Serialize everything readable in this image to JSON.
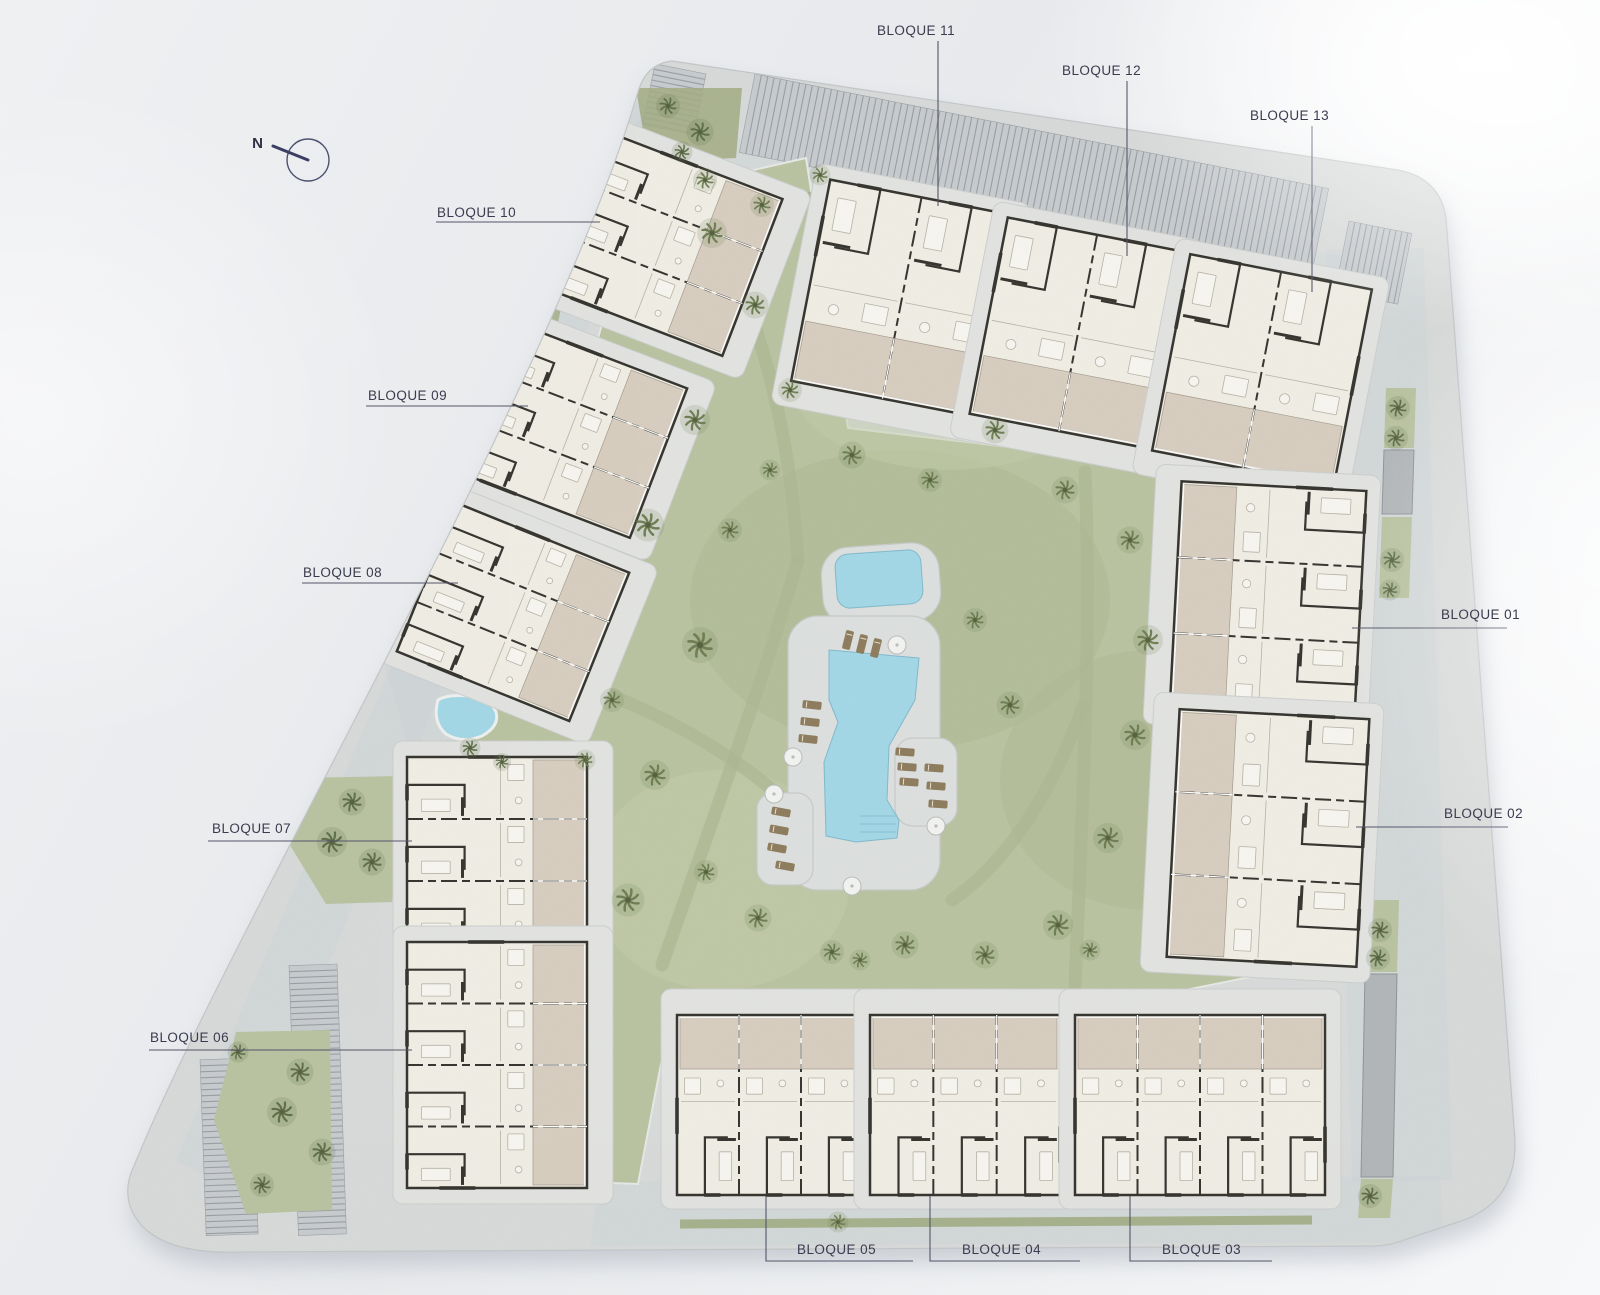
{
  "north": {
    "label": "N"
  },
  "labels": {
    "b01": "BLOQUE 01",
    "b02": "BLOQUE 02",
    "b03": "BLOQUE 03",
    "b04": "BLOQUE 04",
    "b05": "BLOQUE 05",
    "b06": "BLOQUE 06",
    "b07": "BLOQUE 07",
    "b08": "BLOQUE 08",
    "b09": "BLOQUE 09",
    "b10": "BLOQUE 10",
    "b11": "BLOQUE 11",
    "b12": "BLOQUE 12",
    "b13": "BLOQUE 13"
  },
  "palette": {
    "pavement": "#d8dad9",
    "pavementEdge": "#c2c5c6",
    "shadow": "#a9aeb8",
    "road": "#ccd3d6",
    "lawn": "#b9c2a0",
    "lawnDark": "#adb791",
    "lawnLight": "#c4cca9",
    "hedge": "#a2ac83",
    "palm": "#6e7d52",
    "palmDark": "#5f6f49",
    "water": "#a3d7e6",
    "waterEdge": "#7fb9cc",
    "deck": "#dcdfdd",
    "deckEdge": "#c7cac8",
    "lounger": "#8d7b5c",
    "umbrella": "#f2f3f1",
    "room": "#f0ede4",
    "terrace": "#d7cdbf",
    "wall": "#34332d",
    "roomLine": "#b6b2a5",
    "apron": "#e2e3e0",
    "apronEdge": "#cbcecd",
    "parking": "#c7cbce",
    "parkingRib": "#989ea3",
    "ramp": "#b2b5b8",
    "label": "#3b3b4f",
    "leader": "#55556a",
    "north": "#3c3f63"
  }
}
